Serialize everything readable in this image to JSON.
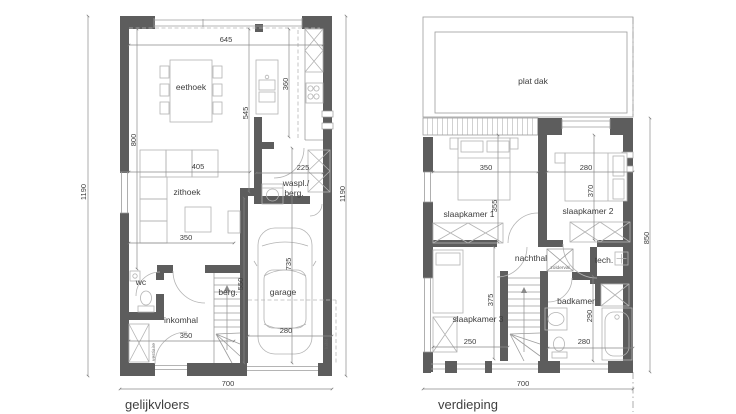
{
  "ground_floor": {
    "title": "gelijkvloers",
    "rooms": {
      "eethoek": "eethoek",
      "zithoek": "zithoek",
      "waspl_line1": "waspl./",
      "waspl_line2": "berg.",
      "wc": "wc",
      "inkomhal": "inkomhal",
      "berging_trap": "berg.",
      "garage": "garage",
      "vestiaire": "vestiaire",
      "luifel": "luifel"
    },
    "dimensions": {
      "total_width": "700",
      "total_depth_left": "1190",
      "total_depth_right": "1190",
      "eethoek_width": "645",
      "living_depth": "800",
      "kitchen_depth": "360",
      "corridor_depth": "545",
      "sofa_width": "405",
      "waspl_width": "225",
      "zithoek_width": "350",
      "inkomhal_width": "350",
      "berg_depth": "550",
      "garage_width": "280",
      "garage_depth": "735"
    }
  },
  "upper_floor": {
    "title": "verdieping",
    "rooms": {
      "plat_dak": "plat dak",
      "slaapkamer1": "slaapkamer 1",
      "slaapkamer2": "slaapkamer 2",
      "slaapkamer3": "slaapkamer 3",
      "nachthal": "nachthal",
      "zolderval": "zolderval",
      "tech": "tech.",
      "badkamer": "badkamer"
    },
    "dimensions": {
      "total_width": "700",
      "total_depth": "850",
      "sk1_width": "350",
      "sk1_depth": "355",
      "sk2_width": "280",
      "sk2_depth": "370",
      "sk3_depth": "375",
      "sk3_width": "250",
      "badkamer_depth": "290",
      "badkamer_width": "280"
    }
  }
}
